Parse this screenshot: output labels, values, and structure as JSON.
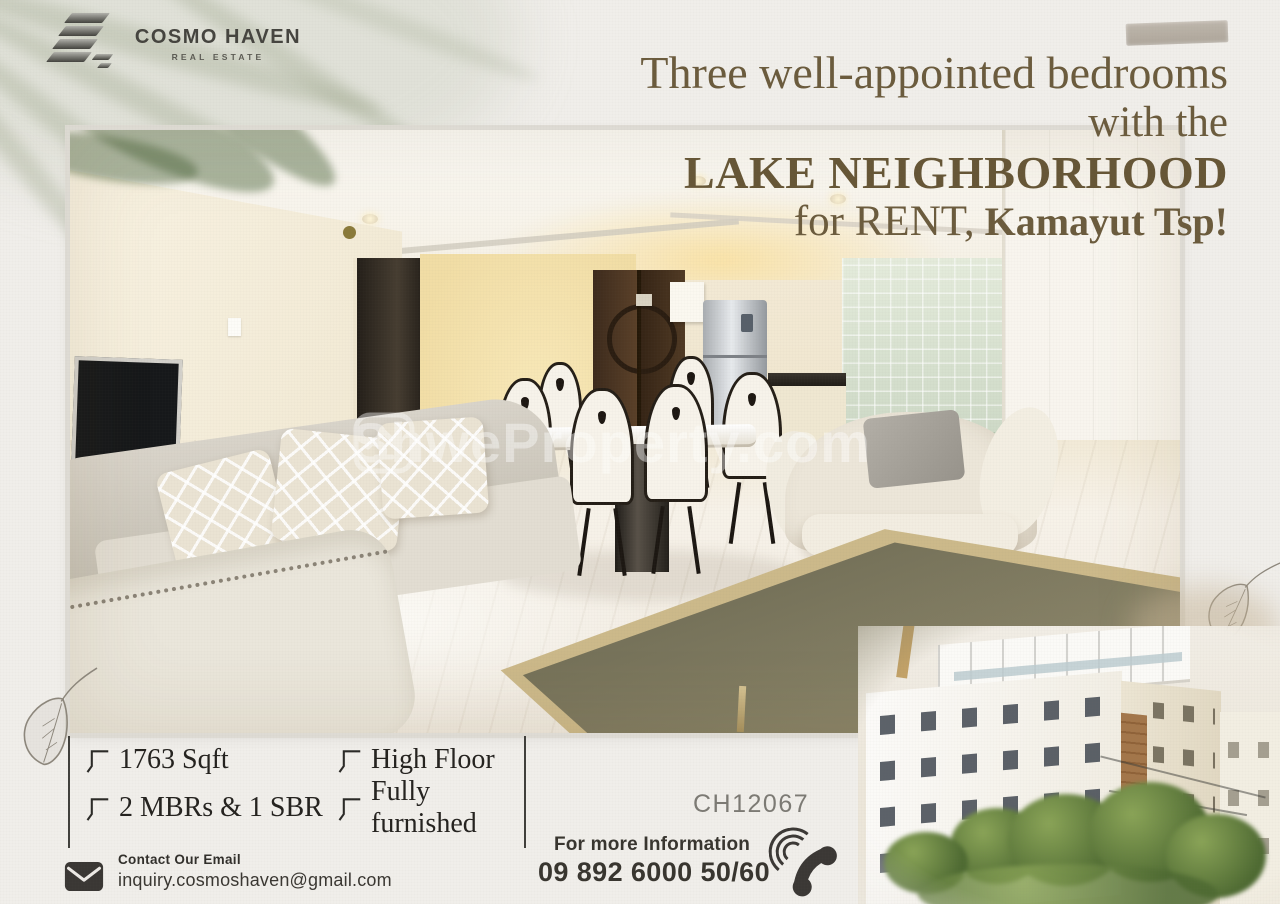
{
  "brand": {
    "name": "COSMO HAVEN",
    "tagline": "REAL ESTATE",
    "logo_icon": "building-stack-icon"
  },
  "decorations": {
    "tape": "washi-tape",
    "palm_shadow": "palm-leaf-shadow",
    "leaf_sketches": "hand-drawn-leaf"
  },
  "headline": {
    "line1": "Three well-appointed bedrooms",
    "line2": "with the",
    "line3": "LAKE NEIGHBORHOOD",
    "line4_regular": "for RENT,",
    "line4_bold": "Kamayut Tsp!"
  },
  "photo": {
    "description": "living-room-interior-photo",
    "watermark_icon": "home-icon",
    "watermark_text": "ShweProperty.com"
  },
  "features": [
    "1763 Sqft",
    "High Floor",
    "2 MBRs & 1 SBR",
    "Fully furnished"
  ],
  "feature_icon": "corner-check-icon",
  "listing_code": "CH12067",
  "contact": {
    "email_icon": "envelope-icon",
    "email_label": "Contact Our Email",
    "email": "inquiry.cosmoshaven@gmail.com",
    "phone_label": "For more Information",
    "phone": "09 892 6000 50/60",
    "phone_icon": "phone-handset-icon"
  },
  "colors": {
    "background": "#f0eeea",
    "headline": "#6b5b3d",
    "text_dark": "#24221f",
    "muted": "#7c7a74",
    "sage_shadow": "#9ea78c",
    "tape": "#b5ada2"
  },
  "building_photo": "apartment-building-exterior-photo"
}
